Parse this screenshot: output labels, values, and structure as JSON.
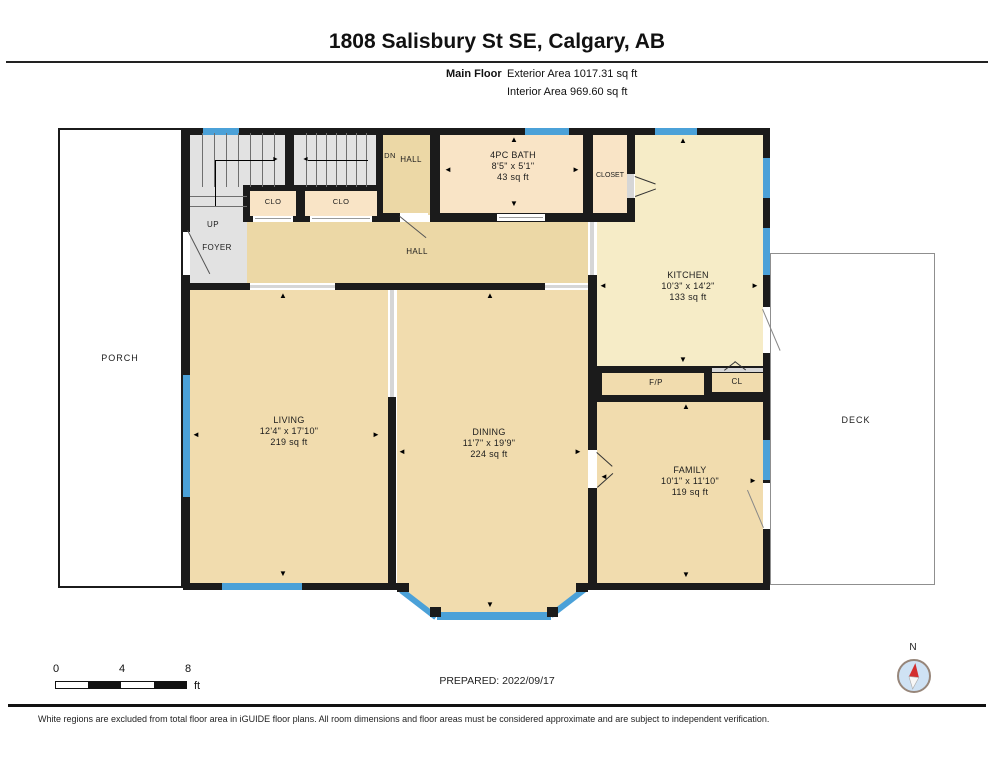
{
  "header": {
    "title": "1808 Salisbury St SE, Calgary, AB",
    "floor_label": "Main Floor",
    "exterior_area": "Exterior Area 1017.31 sq ft",
    "interior_area": "Interior Area 969.60 sq ft"
  },
  "rooms": {
    "living": {
      "name": "LIVING",
      "dims": "12'4\" x 17'10\"",
      "area": "219 sq ft"
    },
    "dining": {
      "name": "DINING",
      "dims": "11'7\" x 19'9\"",
      "area": "224 sq ft"
    },
    "kitchen": {
      "name": "KITCHEN",
      "dims": "10'3\" x 14'2\"",
      "area": "133 sq ft"
    },
    "family": {
      "name": "FAMILY",
      "dims": "10'1\" x 11'10\"",
      "area": "119 sq ft"
    },
    "bath": {
      "name": "4PC BATH",
      "dims": "8'5\" x 5'1\"",
      "area": "43 sq ft"
    }
  },
  "labels": {
    "porch": "PORCH",
    "deck": "DECK",
    "hall": "HALL",
    "dn": "DN",
    "dn_hall": "HALL",
    "up": "UP",
    "foyer": "FOYER",
    "clo1": "CLO",
    "clo2": "CLO",
    "closet": "CLOSET",
    "fp": "F/P",
    "cl": "CL"
  },
  "scale_bar": {
    "tick0": "0",
    "tick1": "4",
    "tick2": "8",
    "unit": "ft"
  },
  "footer": {
    "prepared": "PREPARED: 2022/09/17",
    "disclaimer": "White regions are excluded from total floor area in iGUIDE floor plans. All room dimensions and floor areas must be considered approximate and are subject to independent verification."
  },
  "compass": {
    "n": "N"
  },
  "icons": {
    "arrow_up": "▲",
    "arrow_down": "▼",
    "arrow_left": "◄",
    "arrow_right": "►"
  },
  "colors": {
    "wall": "#1b1b1b",
    "window": "#4ba1d8",
    "room_tan": "#f1dcae",
    "room_light": "#f9e4c6",
    "kitchen": "#f6ecc7",
    "hall": "#ecd8a6",
    "stairs": "#e2e2e2",
    "compass_needle": "#d32f2f"
  }
}
